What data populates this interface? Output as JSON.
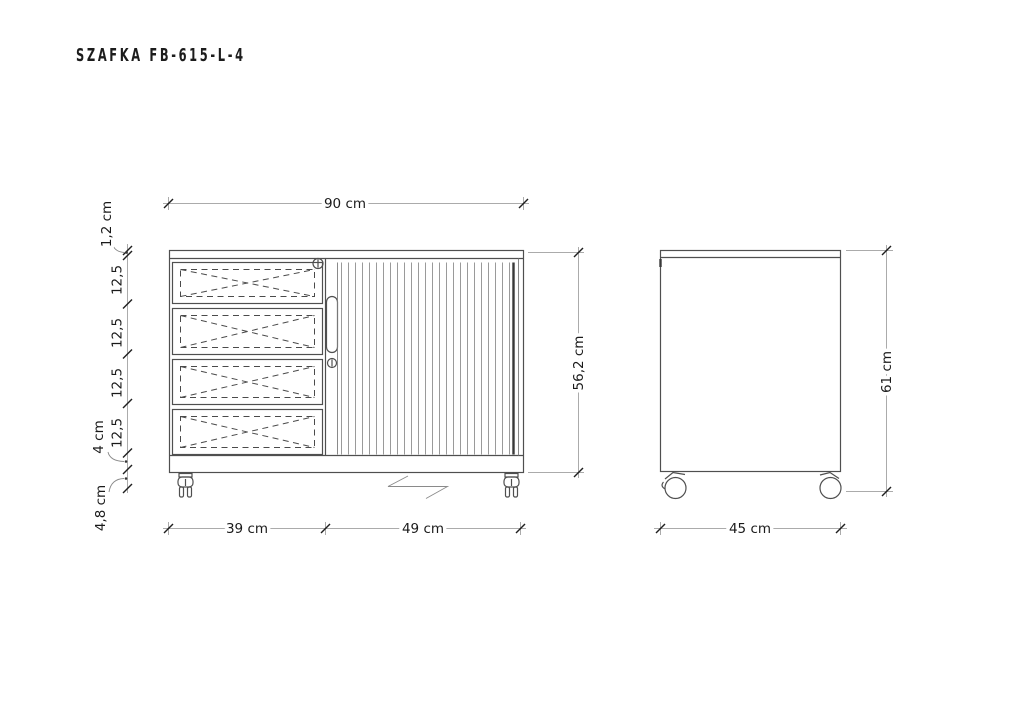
{
  "title": "SZAFKA FB-615-L-4",
  "colors": {
    "background": "#ffffff",
    "outline": "#4f4f4f",
    "dimension_line": "#ababab",
    "tick": "#1f1f1f",
    "text": "#1a1a1a"
  },
  "front_view": {
    "width_label": "90 cm",
    "top_panel_label": "1,2 cm",
    "drawer_labels": [
      "12,5",
      "12,5",
      "12,5",
      "12,5"
    ],
    "plinth_label": "4 cm",
    "caster_height_label": "4,8 cm",
    "drawers_width_label": "39 cm",
    "door_width_label": "49 cm",
    "body_height_label": "56,2 cm"
  },
  "side_view": {
    "depth_label": "45 cm",
    "total_height_label": "61 cm"
  }
}
